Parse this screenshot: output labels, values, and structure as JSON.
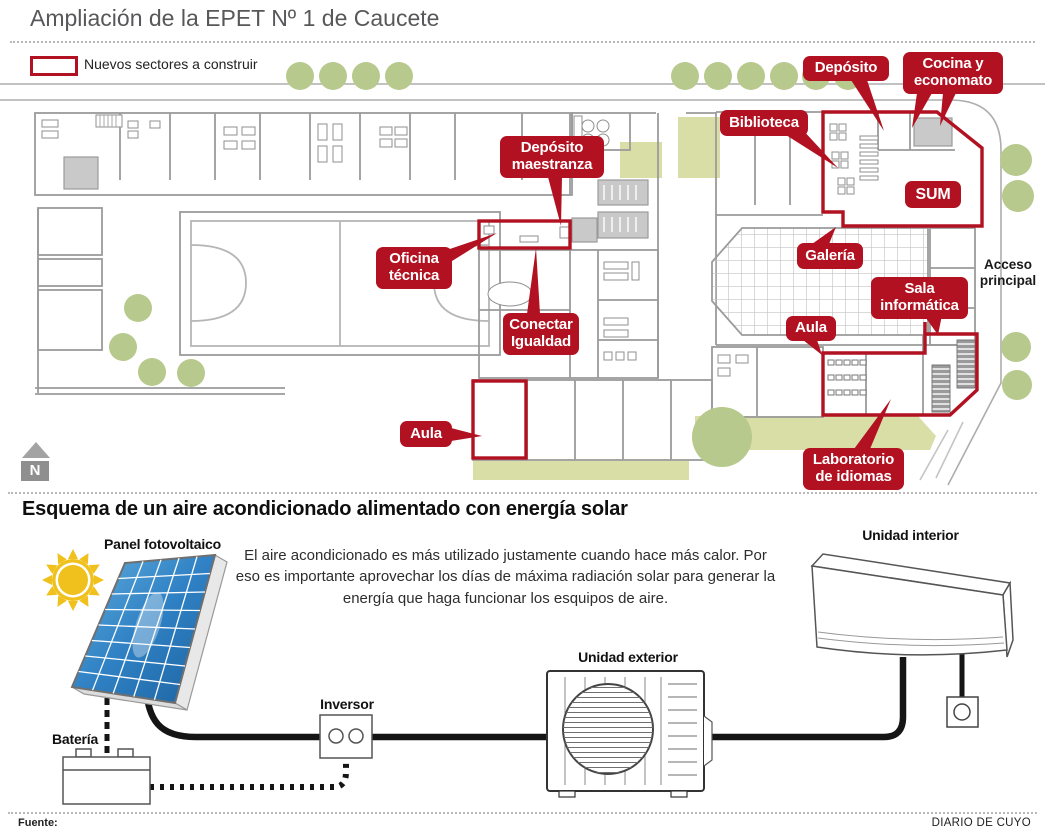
{
  "colors": {
    "accent_red": "#b11120",
    "tree_green": "#b7c98c",
    "patio_green": "#d9dea6"
  },
  "header": {
    "title": "Ampliación de la EPET Nº 1 de Caucete",
    "legend_label": "Nuevos sectores a construir"
  },
  "floorplan": {
    "labels": {
      "deposito": "Depósito",
      "cocina_economato": "Cocina y economato",
      "biblioteca": "Biblioteca",
      "sum": "SUM",
      "galeria": "Galería",
      "sala_informatica": "Sala informática",
      "aula_derecha": "Aula",
      "laboratorio_idiomas": "Laboratorio de idiomas",
      "deposito_maestranza": "Depósito maestranza",
      "oficina_tecnica": "Oficina técnica",
      "conectar_igualdad": "Conectar Igualdad",
      "aula_izquierda": "Aula"
    },
    "acceso_principal": "Acceso principal",
    "north": "N"
  },
  "solar": {
    "title": "Esquema de un aire acondicionado alimentado con energía solar",
    "description": "El aire acondicionado es más utilizado justamente cuando hace más calor. Por\neso es importante aprovechar los días de máxima radiación solar para generar la\nenergía que haga funcionar los esquipos de aire.",
    "labels": {
      "panel": "Panel fotovoltaico",
      "bateria": "Batería",
      "inversor": "Inversor",
      "unidad_exterior": "Unidad exterior",
      "unidad_interior": "Unidad interior"
    }
  },
  "footer": {
    "fuente": "Fuente:",
    "credito": "DIARIO DE CUYO"
  }
}
